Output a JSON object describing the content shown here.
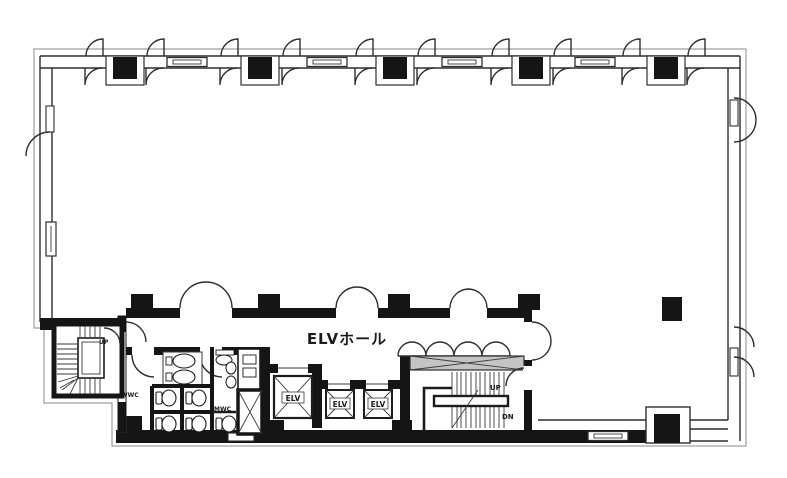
{
  "labels": {
    "hall": "ELVホール",
    "elevator": "ELV",
    "up": "UP",
    "down": "DN",
    "womens_wc": "WWC",
    "mens_wc": "MWC"
  },
  "colors": {
    "background": "#ffffff",
    "line": "#2e2e2e",
    "wall_fill": "#151515",
    "hatch_fill": "#c4c4c4"
  }
}
